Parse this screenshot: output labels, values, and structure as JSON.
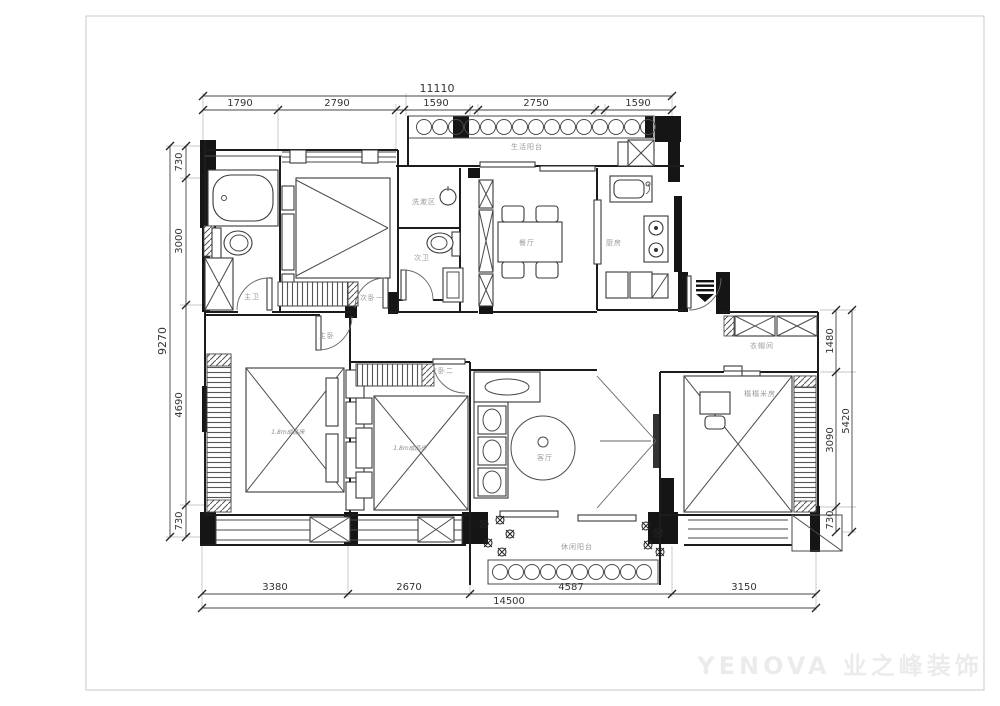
{
  "watermark": {
    "text": "YENOVA 业之峰装饰"
  },
  "dimensions": {
    "top": {
      "total": "11110",
      "segments": [
        "1790",
        "2790",
        "1590",
        "2750",
        "1590"
      ]
    },
    "left": {
      "total": "9270",
      "segments": [
        "730",
        "3000",
        "4690",
        "730"
      ]
    },
    "right": {
      "total": "5420",
      "segments": [
        "1480",
        "3090",
        "730"
      ]
    },
    "bottom": {
      "total": "14500",
      "segments": [
        "3380",
        "2670",
        "4587",
        "3150"
      ]
    }
  },
  "rooms": {
    "service_balcony": "生活阳台",
    "bedroom_one": "次卧一",
    "master_bath": "主卫",
    "wash_area": "洗漱区",
    "guest_bath": "次卫",
    "dining_room": "餐厅",
    "kitchen": "厨房",
    "master_bedroom": "主卧",
    "bedroom_two": "次卧二",
    "cloakroom": "衣帽间",
    "tatami_room": "榻榻米房",
    "living_room": "客厅",
    "leisure_balcony": "休闲阳台"
  },
  "furniture": {
    "master_bed_label": "1.8m成品床",
    "bedroom_two_bed_label": "1.8m成品床"
  }
}
